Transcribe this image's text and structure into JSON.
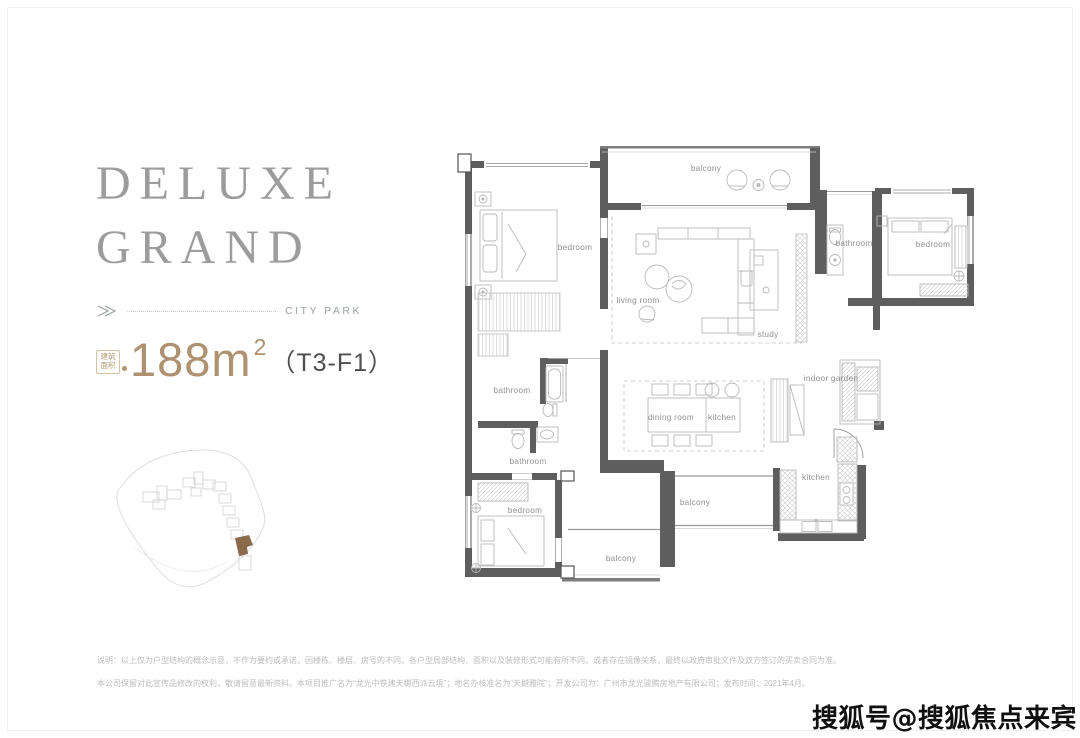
{
  "header": {
    "title_line1": "DELUXE",
    "title_line2": "GRAND",
    "location_label": "CITY PARK",
    "area_stamp": {
      "line1": "建筑",
      "line2": "面积"
    },
    "area_value": "188m",
    "area_exponent": "2",
    "unit_code": "（T3-F1）"
  },
  "colors": {
    "accent_gold": "#ad9170",
    "title_gray": "#9c9c9c",
    "wall_dark": "#5e5e5e",
    "highlight_building": "#8a6a4b"
  },
  "floorplan": {
    "rooms": [
      {
        "id": "balcony-top",
        "label": "balcony"
      },
      {
        "id": "bedroom-top-left",
        "label": "bedroom"
      },
      {
        "id": "living-room",
        "label": "living room"
      },
      {
        "id": "study",
        "label": "study"
      },
      {
        "id": "bathroom-top-right",
        "label": "bathroom"
      },
      {
        "id": "bedroom-right",
        "label": "bedroom"
      },
      {
        "id": "bathroom-mid-upper",
        "label": "bathroom"
      },
      {
        "id": "bathroom-mid-lower",
        "label": "bathroom"
      },
      {
        "id": "dining-room",
        "label": "dining room"
      },
      {
        "id": "kitchen-open",
        "label": "kitchen"
      },
      {
        "id": "indoor-garden",
        "label": "indoor garden"
      },
      {
        "id": "kitchen",
        "label": "kitchen"
      },
      {
        "id": "bedroom-bottom",
        "label": "bedroom"
      },
      {
        "id": "balcony-right",
        "label": "balcony"
      },
      {
        "id": "balcony-bottom",
        "label": "balcony"
      }
    ]
  },
  "disclaimer": {
    "line1": "说明：以上仅为户型结构的概念示意，不作为要约或承诺，因楼栋、楼层、房号的不同，各户型局部结构、面积以及装修形式可能有所不同，或者存在镜像关系，最终以政府审批文件及双方签订的买卖合同为准。",
    "line2": "本公司保留对此宣传品修改的权利，敬请留意最新资料。本项目推广名为“龙光中铁建天樾西派云境”；地名办核准名为“天樾雅院”；开发公司为：广州市龙光骏腾房地产有限公司；发布时间：2021年4月。"
  },
  "watermark": "搜狐号@搜狐焦点来宾站"
}
